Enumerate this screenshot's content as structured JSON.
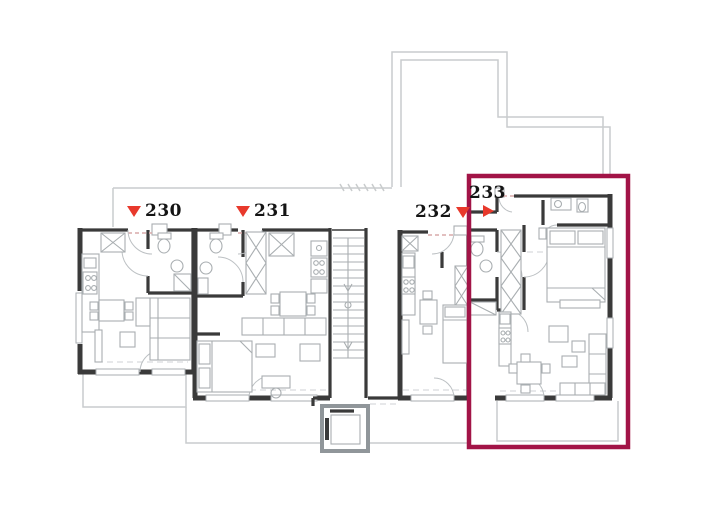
{
  "plan": {
    "type": "residential-floor-plan",
    "highlighted_unit": "233"
  },
  "units": [
    {
      "id": "230",
      "label": "230",
      "marker": "down",
      "highlighted": false
    },
    {
      "id": "231",
      "label": "231",
      "marker": "down",
      "highlighted": false
    },
    {
      "id": "232",
      "label": "232",
      "marker": "down",
      "highlighted": false
    },
    {
      "id": "233",
      "label": "233",
      "marker": "right",
      "highlighted": true
    }
  ],
  "colors": {
    "highlight": "#a21447",
    "marker": "#e8392c",
    "wall": "#3a3a3a",
    "furniture": "#a9aeb1",
    "outline": "#c9cccd",
    "threshold": "#d8aaaa",
    "shaft": "#90969a",
    "background": "#ffffff"
  }
}
